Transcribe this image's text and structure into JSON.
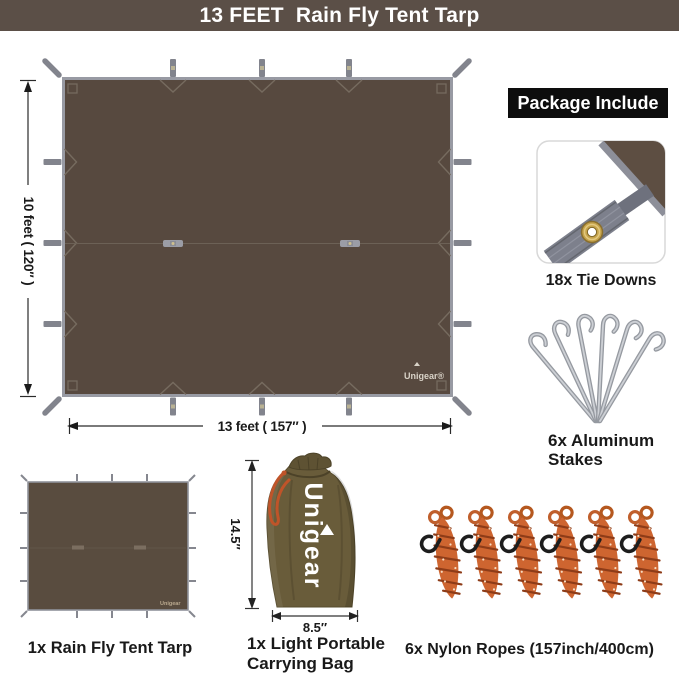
{
  "banner": {
    "title": "13 FEET  Rain Fly Tent Tarp",
    "bg_color": "#5b4f47",
    "text_color": "#ffffff"
  },
  "tarp_diagram": {
    "height_label": "10 feet ( 120″ )",
    "width_label": "13 feet ( 157″ )",
    "brand": "Unigear®",
    "fabric_color": "#57493f",
    "edge_color": "#989aa3"
  },
  "package_include": {
    "header": "Package Include",
    "tie_downs_label": "18x Tie Downs",
    "stakes_label": "6x Aluminum Stakes",
    "ropes_label": "6x Nylon Ropes (157inch/400cm)"
  },
  "bottom_items": {
    "tarp_label": "1x Rain Fly Tent Tarp",
    "bag_label": "1x Light Portable Carrying Bag"
  },
  "carry_bag": {
    "brand": "Unigear",
    "height_label": "14.5″",
    "width_label": "8.5″",
    "fabric_color": "#695c3a"
  },
  "thumb_tarp": {
    "brand": "Unigear"
  },
  "palette": {
    "banner_bg": "#5b4f47",
    "tarp_brown": "#57493f",
    "edge_gray": "#989aa3",
    "rope_orange": "#ce6530",
    "bag_olive": "#695c3a",
    "label_black": "#191919",
    "grommet_brass": "#c6a44c"
  }
}
